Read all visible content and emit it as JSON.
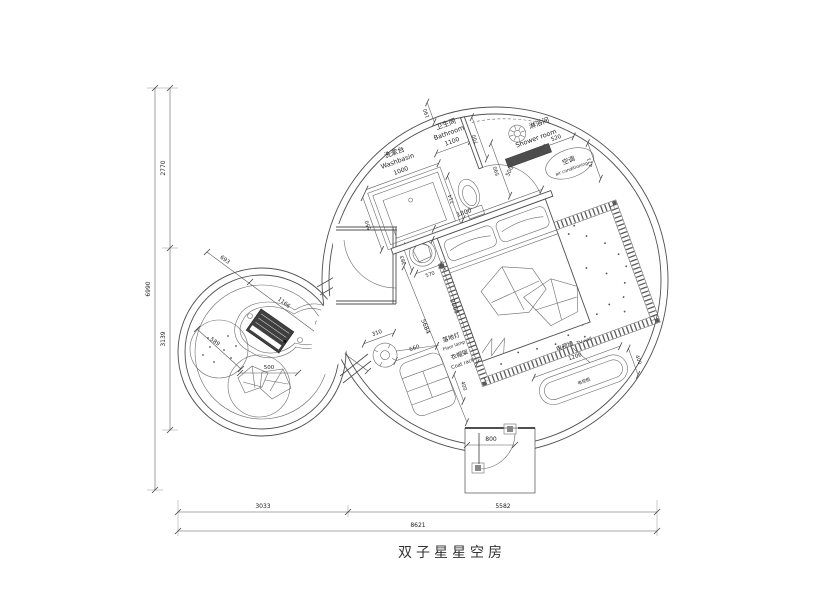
{
  "title": "双子星星空房",
  "overall": {
    "left_total": "6990",
    "left_upper": "2770",
    "left_lower": "3139",
    "bottom_a": "3033",
    "bottom_b": "5582",
    "bottom_total": "8621"
  },
  "rooms": {
    "washbasin": {
      "zh": "洗漱台",
      "en": "Washbasin",
      "width": "1000",
      "depth": "550"
    },
    "bathroom": {
      "zh": "卫生间",
      "en": "Bathroom",
      "width": "1100",
      "wall": "190",
      "door": "700",
      "toilet": "714"
    },
    "shower": {
      "zh": "淋浴间",
      "en": "Shower room",
      "door": "500",
      "width": "590"
    },
    "ac": {
      "zh": "空调",
      "en": "air conditioning",
      "width": "520",
      "depth": "421"
    }
  },
  "bed": {
    "width": "1800",
    "length": "2000",
    "side_a": "383",
    "side_b": "570",
    "diag": "5684"
  },
  "tv": {
    "wall_zh": "电视墙",
    "wall_en": "TV wall",
    "cabinet_zh": "电视柜",
    "length": "1200",
    "depth": "400"
  },
  "coat_rack": {
    "zh": "衣帽架",
    "en": "Coat rack",
    "length": "660",
    "depth": "400"
  },
  "floor_lamp": {
    "zh": "落地灯",
    "en": "Floor lamp",
    "dia": "310"
  },
  "entry": {
    "door": "800"
  },
  "lounge": {
    "seg_a": "693",
    "table": "1166",
    "seg_b": "745",
    "pouf": "589",
    "chair": "500"
  }
}
